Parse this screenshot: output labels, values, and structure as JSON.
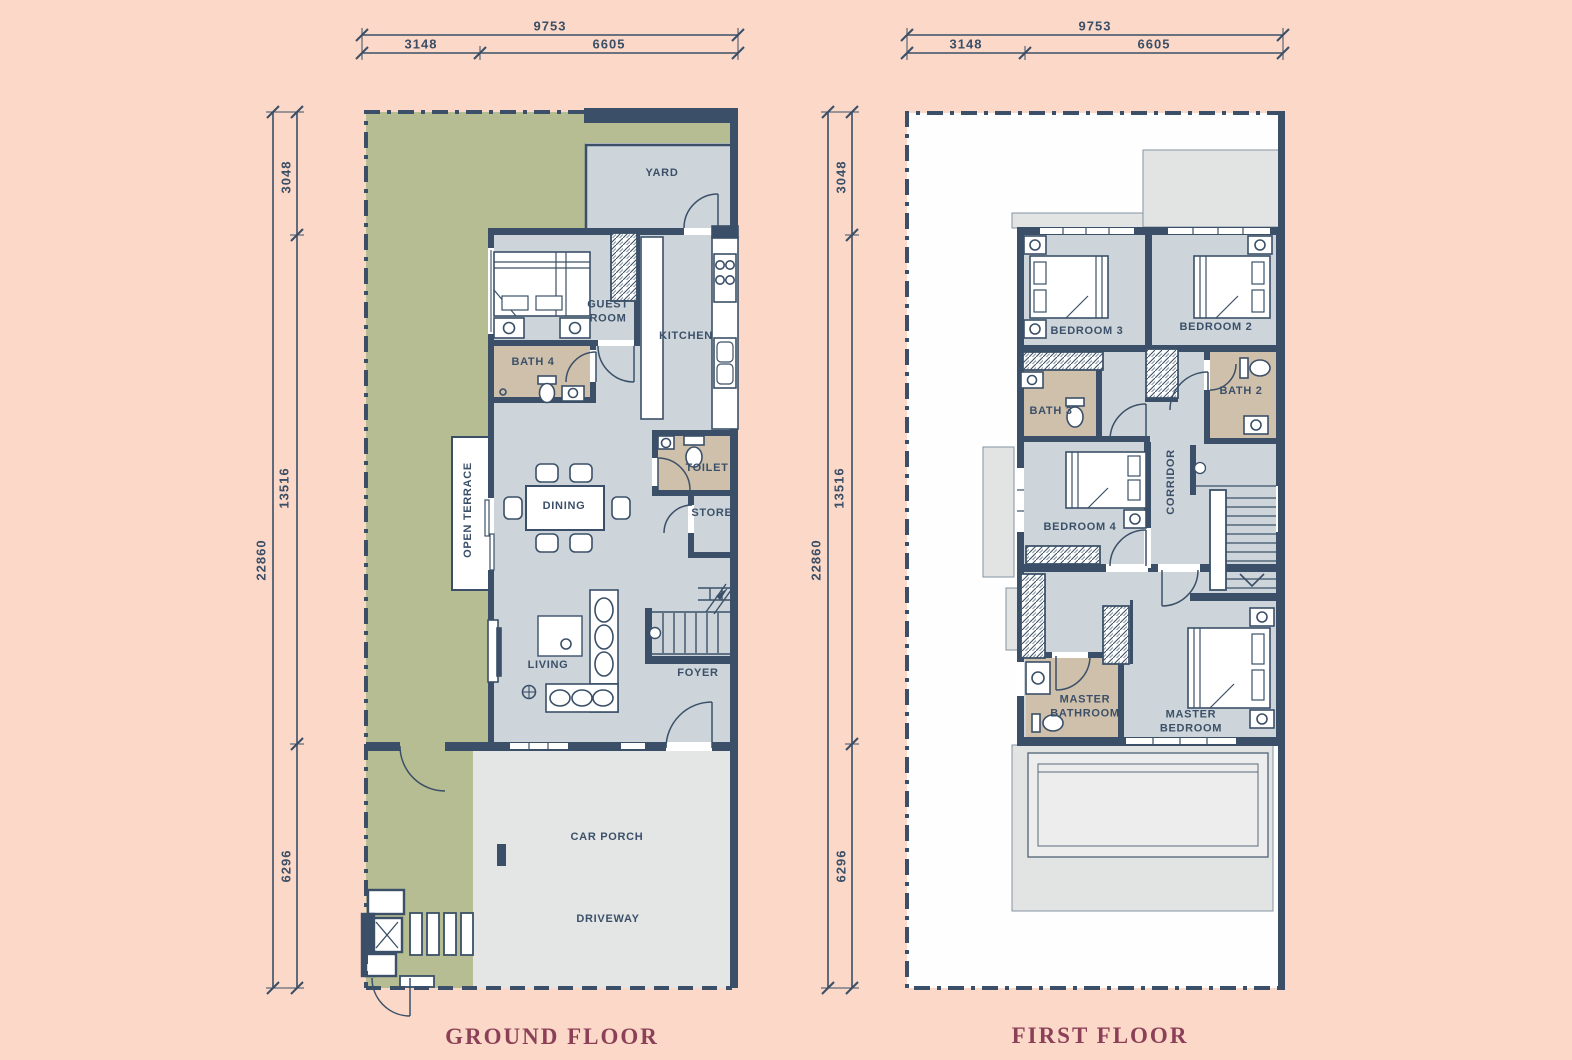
{
  "colors": {
    "background": "#fbd8c8",
    "wall": "#3b5068",
    "floor": "#cdd5db",
    "garden": "#b7bd92",
    "wet_area": "#cfc0ab",
    "paving": "#e4e6e6",
    "roof": "#e2e4e3",
    "title_text": "#8c4057",
    "label_text": "#3b5068"
  },
  "dimensions": {
    "total_width": "9753",
    "width_left": "3148",
    "width_right": "6605",
    "total_height": "22860",
    "height_top": "3048",
    "height_mid": "13516",
    "height_bottom": "6296"
  },
  "ground_floor": {
    "title": "GROUND FLOOR",
    "rooms": {
      "yard": "YARD",
      "guest_room": "GUEST ROOM",
      "kitchen": "KITCHEN",
      "bath4": "BATH 4",
      "open_terrace": "OPEN TERRACE",
      "dining": "DINING",
      "toilet": "TOILET",
      "store": "STORE",
      "living": "LIVING",
      "foyer": "FOYER",
      "car_porch": "CAR PORCH",
      "driveway": "DRIVEWAY"
    }
  },
  "first_floor": {
    "title": "FIRST FLOOR",
    "rooms": {
      "bedroom3": "BEDROOM 3",
      "bedroom2": "BEDROOM 2",
      "bath3": "BATH 3",
      "bath2": "BATH 2",
      "bedroom4": "BEDROOM 4",
      "corridor": "CORRIDOR",
      "master_bathroom": "MASTER BATHROOM",
      "master_bedroom": "MASTER BEDROOM"
    }
  }
}
